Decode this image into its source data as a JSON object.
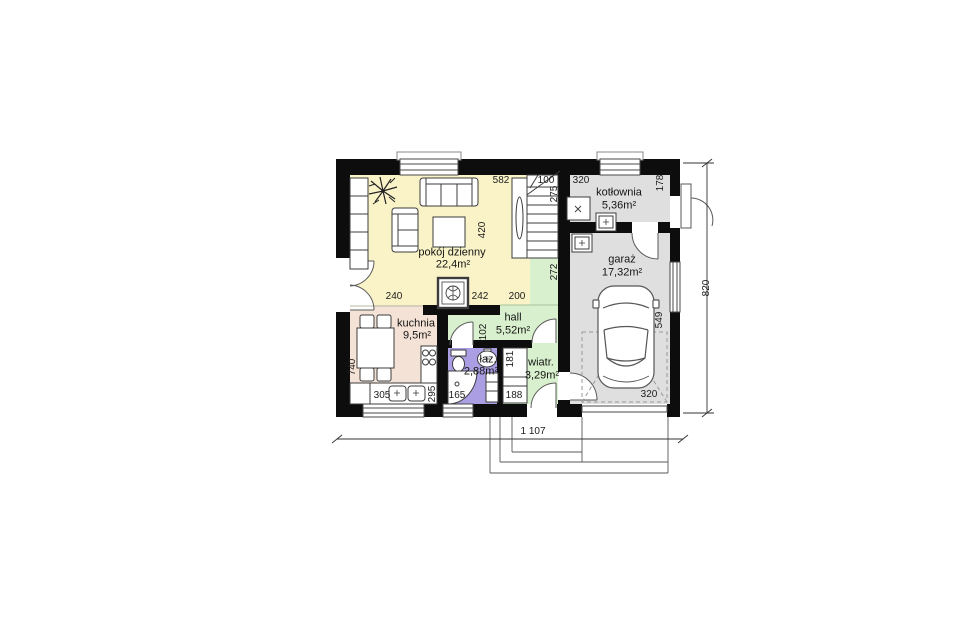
{
  "rooms": {
    "living": {
      "label": "pokój dzienny",
      "area": "22,4m²"
    },
    "kitchen": {
      "label": "kuchnia",
      "area": "9,5m²"
    },
    "hall": {
      "label": "hall",
      "area": "5,52m²"
    },
    "bathroom": {
      "label": "łaz.",
      "area": "2,88m²"
    },
    "vestibule": {
      "label": "wiatr.",
      "area": "3,29m²"
    },
    "boiler_room": {
      "label": "kotłownia",
      "area": "5,36m²"
    },
    "garage": {
      "label": "garaż",
      "area": "17,32m²"
    }
  },
  "dimensions": {
    "living_width": "582",
    "stair_width": "100",
    "stair_run": "275",
    "boiler_width": "320",
    "boiler_depth": "178",
    "living_depth": "420",
    "stair_corridor": "272",
    "kitchen_opening": "240",
    "fireplace_offset": "242",
    "hall_opening": "200",
    "bath_door": "102",
    "kitchen_depth": "740",
    "kitchen_counter": "305",
    "kitchen_width": "295",
    "bath_width": "165",
    "wardrobe_top": "181",
    "wardrobe_bottom": "188",
    "garage_depth": "549",
    "garage_width": "320",
    "total_depth": "820",
    "total_width": "1 107"
  },
  "colors": {
    "wall": "#0d0d0d",
    "living": "#faf3c8",
    "kitchen": "#f3e2d5",
    "hall": "#d8f0cd",
    "bathroom": "#ab9ee2",
    "garage": "#dfdfdf",
    "line": "#3c3c3c"
  }
}
